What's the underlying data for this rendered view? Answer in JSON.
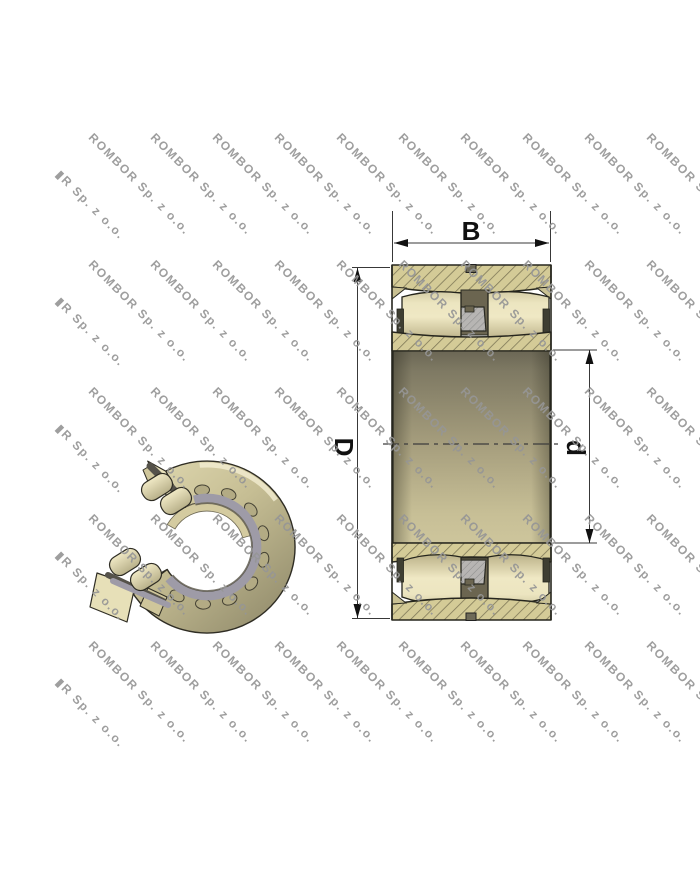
{
  "watermark": {
    "text": "ROMBOR Sp. z o.o.",
    "partial_text": "▮R Sp. z o.o.",
    "color": "#969696"
  },
  "cross_section": {
    "labels": {
      "width": "B",
      "outer_diameter": "D",
      "bore_diameter": "d"
    }
  },
  "colors": {
    "ring_fill": "#d4cb97",
    "hatch_line": "#7e7857",
    "roller_light": "#efe8c4",
    "cage_dark": "#6b6550",
    "guide_ring_gray": "#b7b5b3",
    "outline": "#26261e",
    "dimension_line": "#383838"
  }
}
